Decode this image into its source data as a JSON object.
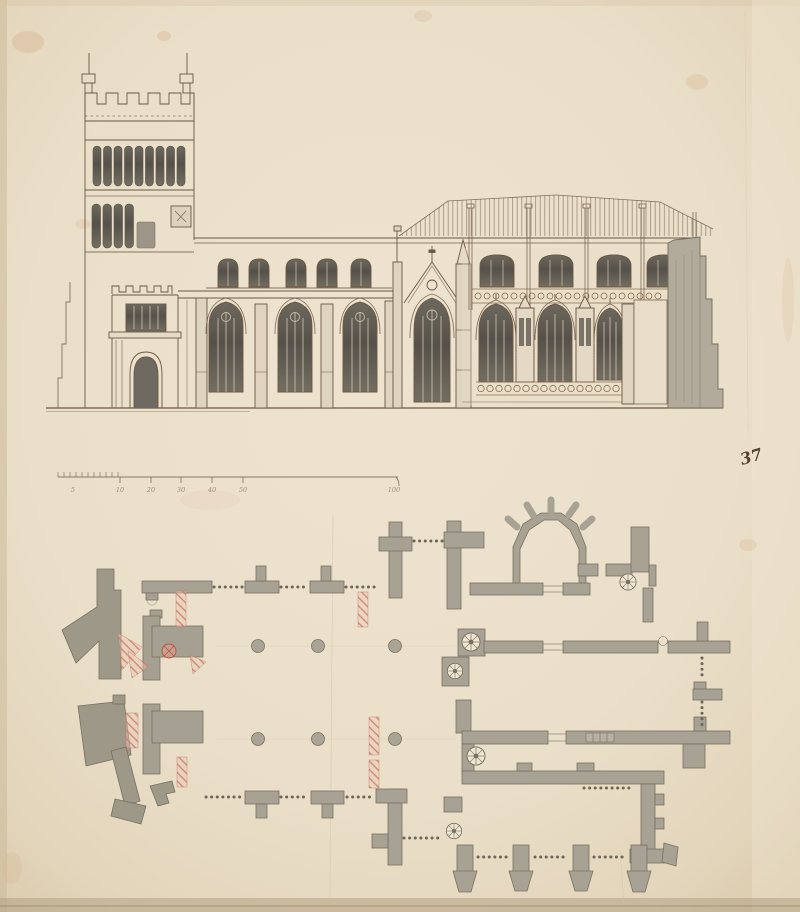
{
  "sheet": {
    "folio_number": "37",
    "drawing_type": "ink-and-wash architectural drawing of a church",
    "views": {
      "elevation": {
        "name": "church side elevation",
        "parts": [
          "west-tower",
          "tower-battlements",
          "corner-pinnacles",
          "belfry-windows",
          "clock-face",
          "west-porch",
          "porch-window",
          "porch-doorway",
          "aisle-windows",
          "clerestory-windows",
          "stepped-buttresses",
          "gabled-bay",
          "gable-window",
          "choir-bays",
          "choir-clerestory",
          "pierced-parapet-band",
          "pinnacle-shafts",
          "east-buttress-mass",
          "roof-hatching",
          "ground-line"
        ]
      },
      "plan": {
        "name": "ground plan",
        "parts": [
          "west-tower-piers",
          "red-chalk-alterations",
          "arcade-columns",
          "north-wall-buttresses",
          "south-wall-buttresses",
          "apsidal-north-chapel",
          "spiral-staircases",
          "choir-and-chapel-walls",
          "south-chapel-buttresses",
          "door-openings",
          "window-openings-dotted"
        ]
      },
      "scale_bar": {
        "ticks": [
          {
            "label": "5"
          },
          {
            "label": "10"
          },
          {
            "label": "20"
          },
          {
            "label": "30"
          },
          {
            "label": "40"
          },
          {
            "label": "50"
          },
          {
            "label": "100"
          }
        ]
      }
    },
    "colors": {
      "paper": "#ebe0cb",
      "paper_edge": "#d8c9ab",
      "ink": "#6b5844",
      "wash_gray": "#a8a295",
      "window_dark": "#55514a",
      "red_chalk": "#c4766a",
      "stain": "#d8b694"
    }
  }
}
